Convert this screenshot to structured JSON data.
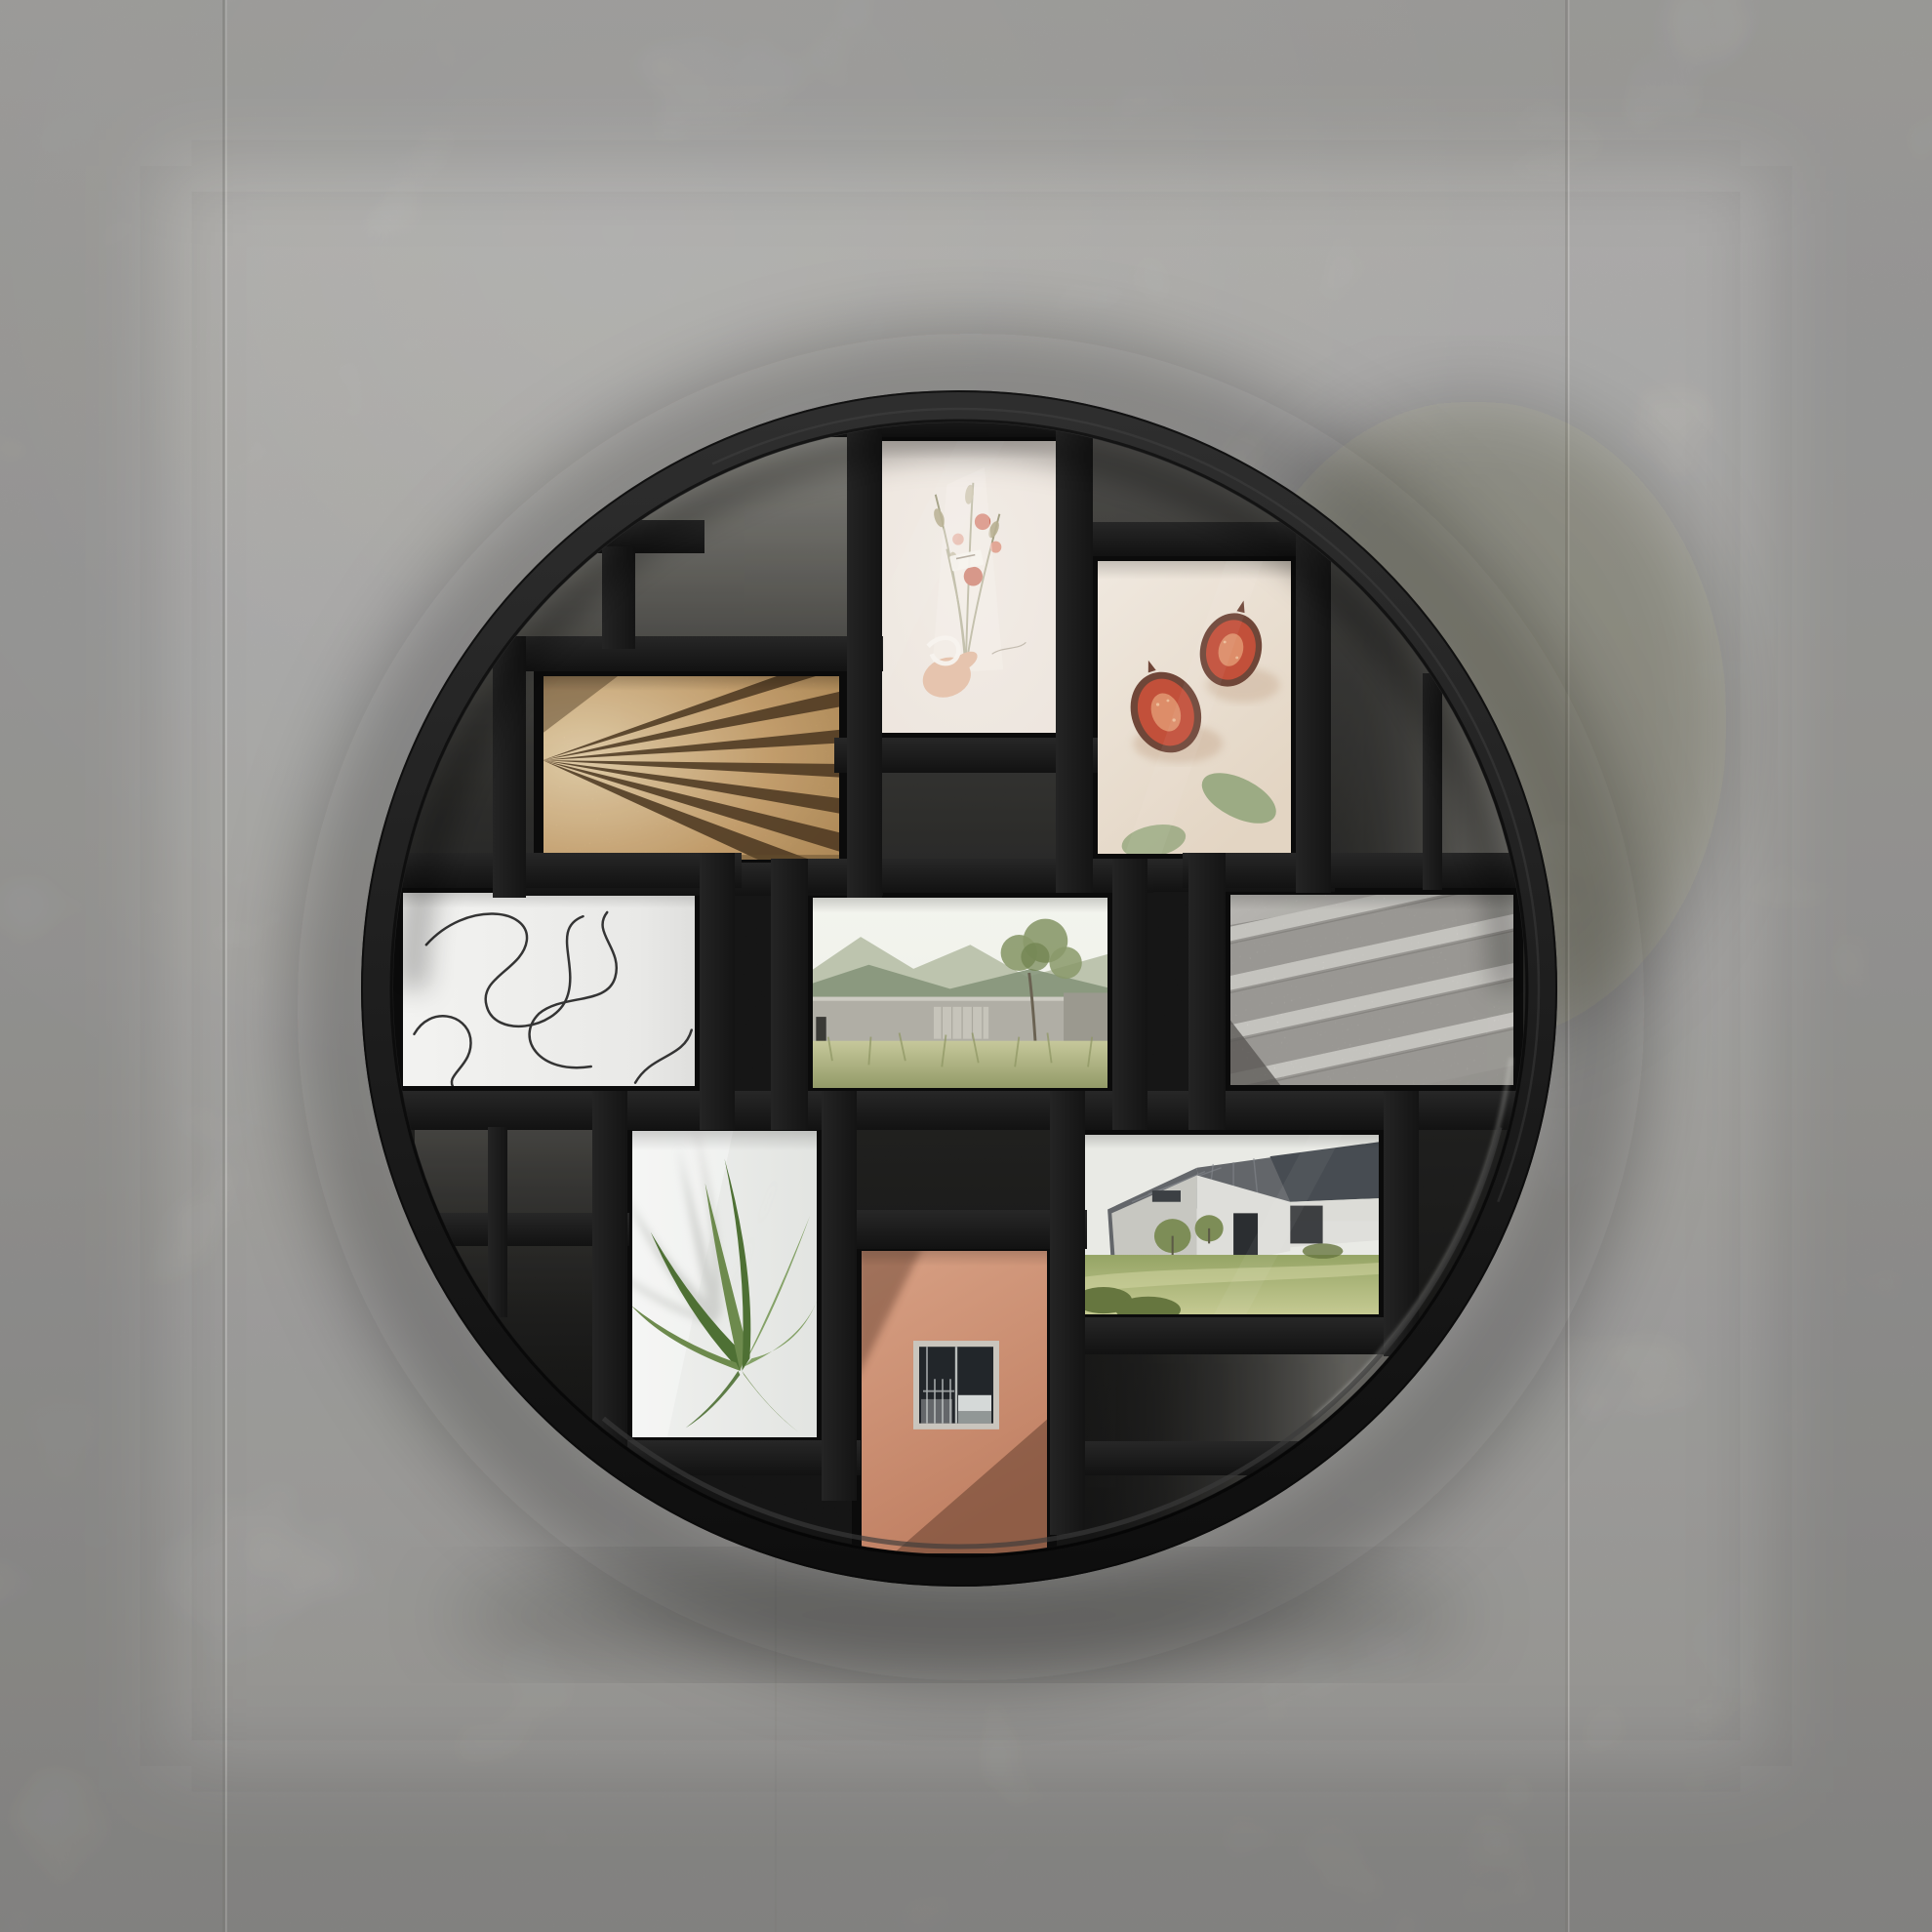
{
  "scene": {
    "kind": "product photograph",
    "subject": "Round black multi-opening photo frame hung on a concrete tile wall",
    "frame": {
      "shape": "circle",
      "finish": "matte black",
      "openings": 9,
      "backdrop": "light grey concrete wall with vertical panel seams"
    }
  },
  "photos": [
    {
      "id": "wood-slats",
      "orientation": "landscape",
      "subject": "Fanned light-wood slats with dark shadow wedges"
    },
    {
      "id": "dried-bouquet",
      "orientation": "portrait",
      "subject": "Hand holding a wrapped dried-flower bouquet on a pale background"
    },
    {
      "id": "figs",
      "orientation": "portrait",
      "subject": "Two halved figs with eucalyptus leaves on cream"
    },
    {
      "id": "line-art",
      "orientation": "landscape",
      "subject": "Abstract continuous-line drawing on white"
    },
    {
      "id": "courtyard",
      "orientation": "landscape",
      "subject": "Low concrete building with mountains, tree and tall grass"
    },
    {
      "id": "stairs",
      "orientation": "landscape",
      "subject": "Granite staircase climbing to the right"
    },
    {
      "id": "palm",
      "orientation": "portrait",
      "subject": "Green palm fronds and leaf shadows on a sunlit wall"
    },
    {
      "id": "orange-facade",
      "orientation": "portrait",
      "subject": "Terracotta facade with a square window and diagonal shadow"
    },
    {
      "id": "modern-house",
      "orientation": "landscape",
      "subject": "White house with dark angular roof and green lawn"
    }
  ],
  "css_vars": {
    "--wall-top": "#cdccc9",
    "--wall-mid": "#c0bfbc",
    "--wall-bot": "#a9a8a5",
    "--seam-dark": "#84837f",
    "--seam-light": "#dedddA",
    "--ring-hi": "#2e2e2e",
    "--ring-lo": "#0e0e0e",
    "--lip": "#3a3a3a",
    "--bar-h1": "#272727",
    "--bar-h2": "#121212",
    "--bar-v1": "#242424",
    "--bar-v2": "#141414",
    "--cav-0": "#504f4b",
    "--cav-1": "#232321",
    "--cav-2": "#0d0d0c",
    "--tl-0": "#96958e",
    "--tl-1": "#55544f",
    "--tr-1": "#7b7a74",
    "--bl-0": "#454440",
    "--br-1": "#716f6a",
    "--photo-frame": "#0b0b0b",
    "--wood-hi": "#ecd7b0",
    "--wood-mid": "#cfa874",
    "--wood-lo": "#b18a55",
    "--wood-dark": "#503a22",
    "--flw-bg": "#ece4dc",
    "--flw-stem": "#9a9879",
    "--flw-leaf": "#b9b193",
    "--flw-red": "#cd6a58",
    "--flw-red2": "#c25c49",
    "--flw-pink": "#e2a796",
    "--flw-hand": "#e6c4ae",
    "--flw-white": "#f7f3ee",
    "--fig-bg": "#f0e9e0",
    "--fig-bg2": "#e3d5c3",
    "--fig-skin": "#6f4638",
    "--fig-flesh": "#c2503a",
    "--fig-core": "#e0936f",
    "--fig-leaf": "#9cab84",
    "--fig-sh": "#cdb49c",
    "--line-bg": "#f3f3f1",
    "--line-ink": "#343434",
    "--land-sky": "#eef0e8",
    "--land-m1": "#b9c1ab",
    "--land-m2": "#85957a",
    "--land-bld": "#b0aea5",
    "--land-bld2": "#9b998f",
    "--land-scr": "#c6c4ba",
    "--land-g1": "#c6c89b",
    "--land-g2": "#8e9663",
    "--land-tree": "#8a996a",
    "--land-tree2": "#6f814f",
    "--st-w1": "#d8d6d1",
    "--st-w2": "#a9a7a2",
    "--st-tread": "#e6e4df",
    "--st-riser": "#b3b1ac",
    "--st-sh": "#6a6864",
    "--palm-bg": "#f0f1ef",
    "--palm-sh": "#c6c8c4",
    "--palm-g1": "#6d8a4d",
    "--palm-g2": "#4e7034",
    "--palm-g3": "#85a268",
    "--org-w1": "#d8a185",
    "--org-w2": "#c08063",
    "--org-sh": "#5e3a2a",
    "--org-frame": "#c9c5bd",
    "--org-win": "#22262a",
    "--org-lite": "#dfe3e1",
    "--hs-sky": "#e9eae5",
    "--hs-hill": "#9fa88e",
    "--hs-w1": "#dededa",
    "--hs-w2": "#c7c7c1",
    "--hs-roof": "#63666a",
    "--hs-roof2": "#474c52",
    "--hs-dark": "#2b2e31",
    "--hs-lawn1": "#c9cd96",
    "--hs-lawn2": "#95a465",
    "--hs-bush": "#66763f",
    "--hs-tree": "#7d8d57"
  }
}
